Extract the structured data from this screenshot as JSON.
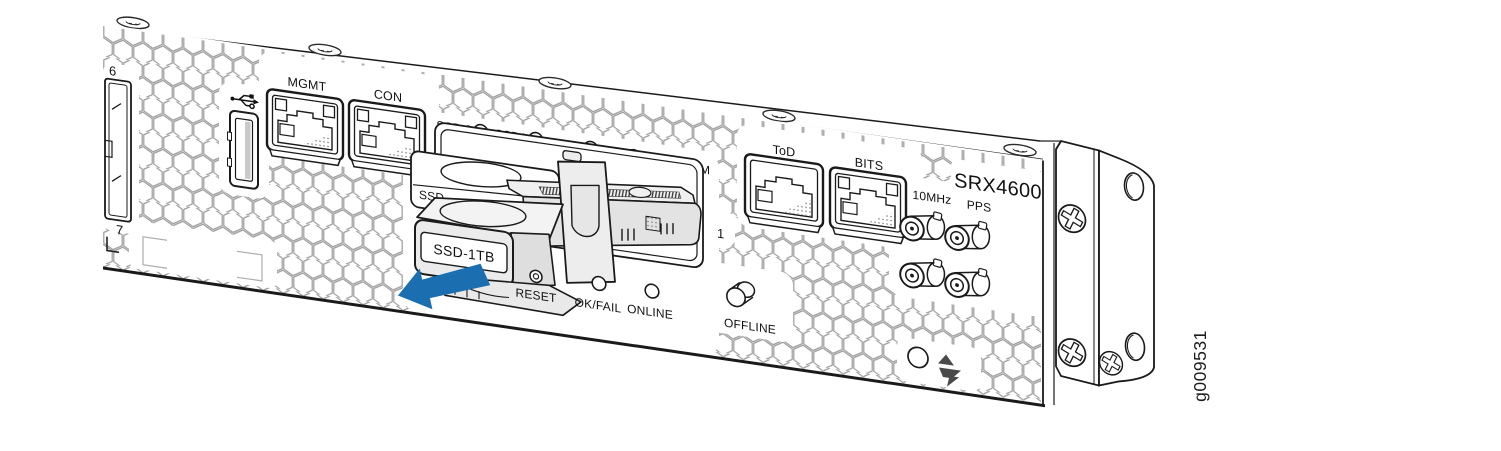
{
  "figure": {
    "id": "g009531"
  },
  "brand": {
    "model": "SRX4600"
  },
  "front_panel": {
    "network_port_numbers": {
      "upper": "6",
      "lower": "7"
    },
    "ports": {
      "mgmt": "MGMT",
      "console": "CON",
      "tod": "ToD",
      "bits": "BITS"
    },
    "leds": {
      "ssd0": "SSD 0",
      "ssd1": "SSD1",
      "mst": "MST",
      "ha": "HA",
      "alm": "ALM",
      "ok_fail": "OK/FAIL",
      "online": "ONLINE"
    },
    "buttons": {
      "reset": "RESET",
      "offline": "OFFLINE"
    },
    "clock_interfaces": {
      "freq_10mhz": "10MHz",
      "pps": "PPS"
    },
    "ssd": {
      "removed_module_label": "SSD-1TB",
      "installed_module_label": "SSD",
      "slot_number": "1"
    }
  },
  "icons": [
    "usb-icon",
    "esd-warning-icon",
    "phillips-screw-icon",
    "countersunk-screw-icon"
  ],
  "colors": {
    "removal_arrow_blue": "#1b6fb0",
    "line_art": "#1a1a1a",
    "honeycomb_gray": "#999999",
    "module_fill_gray": "#e8e8e8"
  }
}
